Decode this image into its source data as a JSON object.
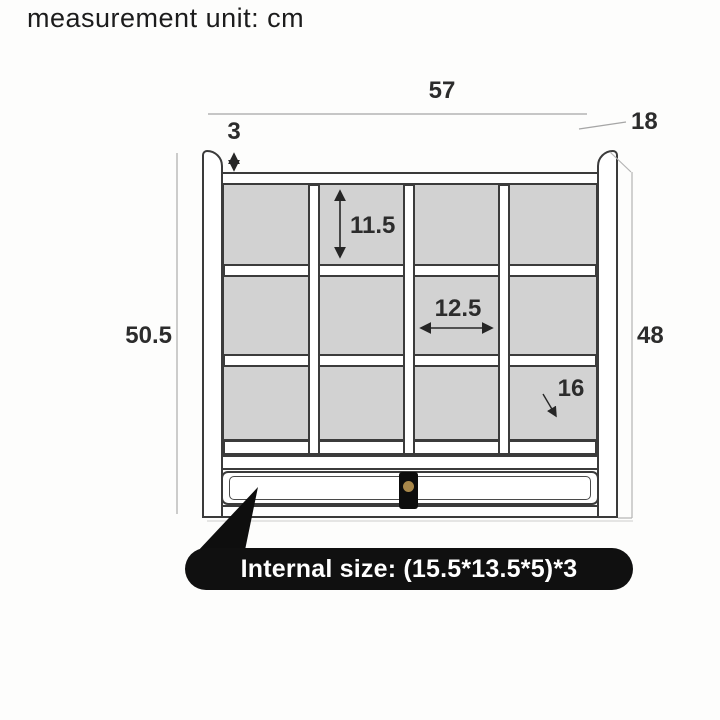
{
  "header": {
    "unit_note": "measurement unit: cm"
  },
  "dims": {
    "overall_width": "57",
    "depth": "18",
    "top_rail": "3",
    "cell_height": "11.5",
    "cell_width": "12.5",
    "cell_depth": "16",
    "overall_height": "50.5",
    "side_height": "48"
  },
  "callout": {
    "text": "Internal size: (15.5*13.5*5)*3"
  },
  "structure": {
    "rows": 3,
    "columns": 4,
    "compartments": 12,
    "has_drawer": true
  },
  "colors": {
    "bg": "#fdfdfc",
    "outline": "#3b3b3b",
    "fill_compartment": "#d2d2d2",
    "callout_bg": "#101010",
    "callout_text": "#ffffff",
    "handle": "#0d0d0d",
    "knob": "#a8874a",
    "dimline_light": "#a8a8a8",
    "dim_text": "#2c2c2c"
  }
}
